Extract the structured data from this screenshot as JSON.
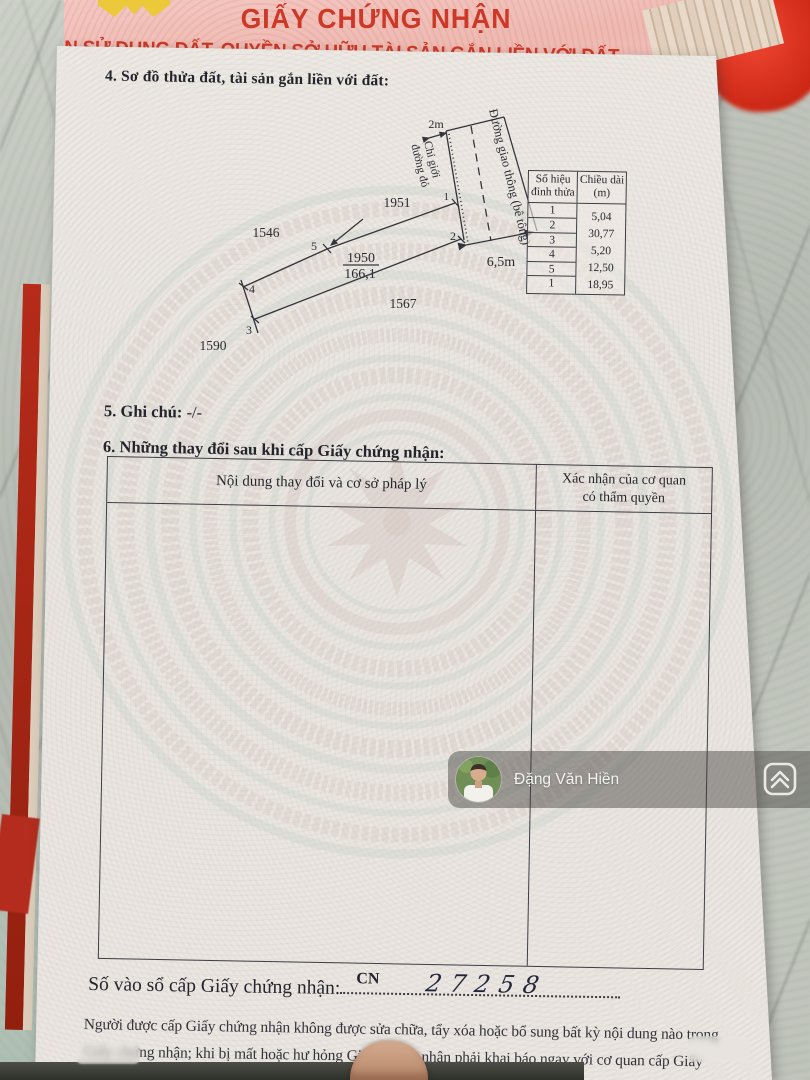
{
  "cover": {
    "title": "GIẤY CHỨNG NHẬN",
    "subtitle": "QUYỀN SỬ DỤNG ĐẤT, QUYỀN SỞ HỮU TÀI SẢN GẮN LIỀN VỚI ĐẤT"
  },
  "section4": {
    "heading": "4. Sơ đồ thửa đất, tài sản gắn liền với đất:",
    "diagram": {
      "road_label": "Đường giao thông (bê tông)",
      "boundary_label_line1": "Chỉ giới",
      "boundary_label_line2": "đường đỏ",
      "setback_dim": "2m",
      "road_width_dim": "6,5m",
      "parcel_number": "1950",
      "parcel_area": "166,1",
      "adjacent_parcels": [
        "1951",
        "1546",
        "1567",
        "1590"
      ],
      "vertices": [
        "1",
        "2",
        "3",
        "4",
        "5"
      ]
    },
    "vertex_table": {
      "col1_header_line1": "Số hiệu",
      "col1_header_line2": "đỉnh thửa",
      "col2_header_line1": "Chiều dài",
      "col2_header_line2": "(m)",
      "vertex_ids": [
        "1",
        "2",
        "3",
        "4",
        "5",
        "1"
      ],
      "lengths": [
        "5,04",
        "30,77",
        "5,20",
        "12,50",
        "18,95"
      ]
    }
  },
  "section5": {
    "heading": "5. Ghi chú:",
    "value": " -/-"
  },
  "section6": {
    "heading": "6. Những thay đổi sau khi cấp Giấy chứng nhận:",
    "col1_header": "Nội dung thay đổi và cơ sở pháp lý",
    "col2_header_line1": "Xác nhận của cơ quan",
    "col2_header_line2": "có thẩm quyền"
  },
  "watermark_overlay": {
    "name": "Đặng Văn Hiền",
    "avatar_icon": "person-photo-avatar",
    "logo_icon": "double-chevron-house-logo"
  },
  "registry": {
    "label": "Số vào sổ cấp Giấy chứng nhận:",
    "prefix": "CN",
    "number": "27258"
  },
  "footer": {
    "line1": "Người được cấp Giấy chứng nhận không được sửa chữa, tẩy xóa hoặc bổ sung bất kỳ nội dung nào trong",
    "line2": "Giấy chứng nhận; khi bị mất hoặc hư hỏng Giấy chứng nhận phải khai báo ngay với cơ quan cấp Giấy"
  },
  "colors": {
    "cover_red_text": "#cd3827",
    "cover_pink": "#f0c0b9",
    "page_paper": "#eae5e0",
    "marble": "#bcc0b8",
    "ink": "#26272e",
    "star_yellow": "#ecc93a",
    "red_object": "#cb2715",
    "band_overlay": "rgba(66,64,58,0.46)"
  }
}
